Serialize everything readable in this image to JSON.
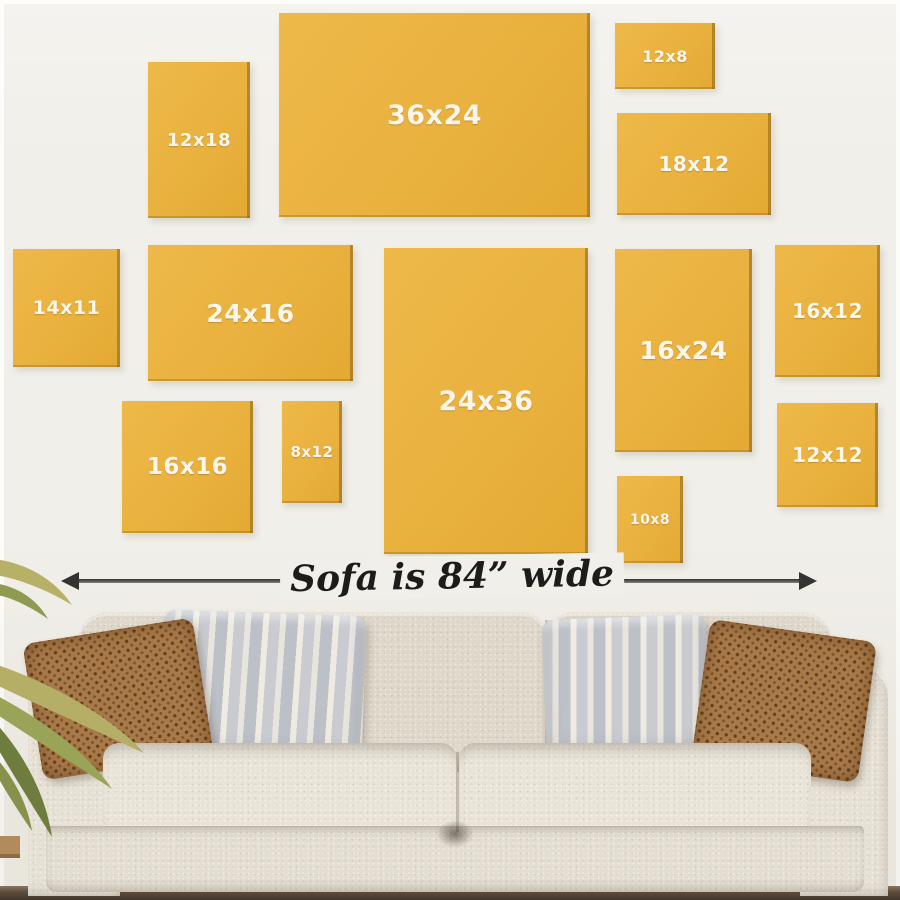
{
  "size_guide": {
    "frames": [
      {
        "label": "12x18"
      },
      {
        "label": "36x24"
      },
      {
        "label": "12x8"
      },
      {
        "label": "18x12"
      },
      {
        "label": "14x11"
      },
      {
        "label": "24x16"
      },
      {
        "label": "24x36"
      },
      {
        "label": "16x24"
      },
      {
        "label": "16x12"
      },
      {
        "label": "16x16"
      },
      {
        "label": "8x12"
      },
      {
        "label": "10x8"
      },
      {
        "label": "12x12"
      }
    ]
  },
  "arrow": {
    "label": "Sofa is 84” wide"
  },
  "colors": {
    "background": "#f1efe9",
    "frame_yellow": "#e9b13e",
    "frame_edge": "#89631d",
    "frame_label_text": "#faf6ec",
    "arrow": "#34332f",
    "sofa_body": "#e4ded2",
    "sofa_back": "#ded7ca",
    "sofa_seat": "#eae4d8",
    "pillow_brown": "#a97a49",
    "pillow_stripe_gray": "#c9cbd0",
    "floor": "#5b4b3c",
    "plant_green": "#8f9a52"
  }
}
